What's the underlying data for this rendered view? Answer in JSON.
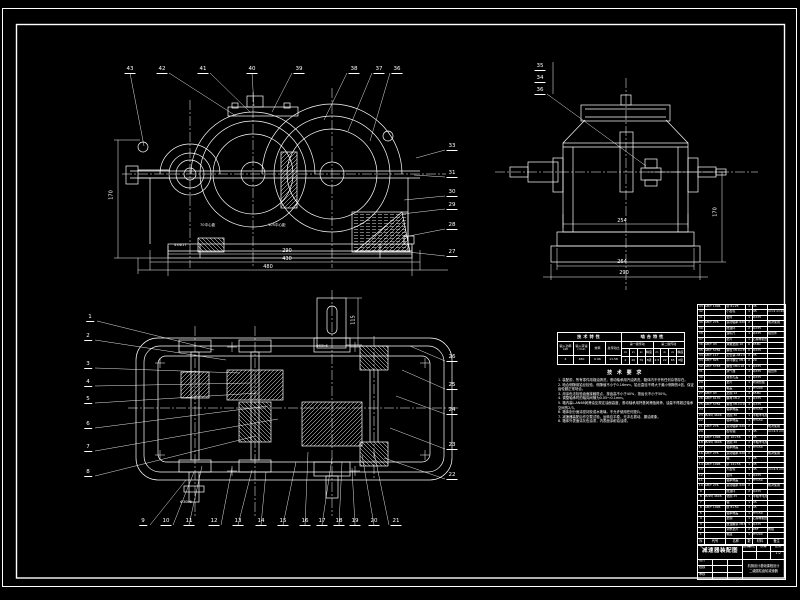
{
  "sheet": {
    "bg": "#000000",
    "line_color": "#ffffff"
  },
  "views": {
    "front": {
      "callouts": [
        {
          "n": "43",
          "x": 130,
          "y": 66,
          "tx": 144,
          "ty": 146
        },
        {
          "n": "42",
          "x": 162,
          "y": 66,
          "tx": 236,
          "ty": 116
        },
        {
          "n": "41",
          "x": 203,
          "y": 66,
          "tx": 250,
          "ty": 112
        },
        {
          "n": "40",
          "x": 252,
          "y": 66,
          "tx": 254,
          "ty": 106
        },
        {
          "n": "39",
          "x": 299,
          "y": 66,
          "tx": 272,
          "ty": 112
        },
        {
          "n": "38",
          "x": 354,
          "y": 66,
          "tx": 324,
          "ty": 120
        },
        {
          "n": "37",
          "x": 379,
          "y": 66,
          "tx": 348,
          "ty": 131
        },
        {
          "n": "36",
          "x": 397,
          "y": 66,
          "tx": 370,
          "ty": 141
        },
        {
          "n": "33",
          "x": 452,
          "y": 143,
          "tx": 416,
          "ty": 158
        },
        {
          "n": "31",
          "x": 452,
          "y": 170,
          "tx": 414,
          "ty": 175
        },
        {
          "n": "30",
          "x": 452,
          "y": 189,
          "tx": 404,
          "ty": 200
        },
        {
          "n": "29",
          "x": 452,
          "y": 202,
          "tx": 402,
          "ty": 214
        },
        {
          "n": "28",
          "x": 452,
          "y": 222,
          "tx": 404,
          "ty": 237
        },
        {
          "n": "27",
          "x": 452,
          "y": 249,
          "tx": 408,
          "ty": 252
        }
      ],
      "dims": [
        {
          "t": "290",
          "x": 287,
          "y": 249
        },
        {
          "t": "430",
          "x": 287,
          "y": 257
        },
        {
          "t": "480",
          "x": 268,
          "y": 265
        },
        {
          "t": "170",
          "x": 112,
          "y": 195,
          "rot": 1
        }
      ],
      "notes": [
        {
          "t": "70中心距",
          "x": 200,
          "y": 223
        },
        {
          "t": "105中心距",
          "x": 268,
          "y": 223
        },
        {
          "t": "4×Φ17",
          "x": 174,
          "y": 243
        }
      ]
    },
    "side": {
      "callouts": [
        {
          "n": "35",
          "x": 540,
          "y": 63
        },
        {
          "n": "34",
          "x": 540,
          "y": 75
        },
        {
          "n": "36",
          "x": 540,
          "y": 87,
          "tx": 646,
          "ty": 166
        }
      ],
      "dims": [
        {
          "t": "254",
          "x": 622,
          "y": 219
        },
        {
          "t": "264",
          "x": 622,
          "y": 260
        },
        {
          "t": "290",
          "x": 624,
          "y": 271
        },
        {
          "t": "170",
          "x": 716,
          "y": 212,
          "rot": 1
        }
      ]
    },
    "plan": {
      "callouts": [
        {
          "n": "1",
          "x": 90,
          "y": 314,
          "tx": 214,
          "ty": 350
        },
        {
          "n": "2",
          "x": 88,
          "y": 333,
          "tx": 226,
          "ty": 360
        },
        {
          "n": "3",
          "x": 88,
          "y": 361,
          "tx": 240,
          "ty": 373
        },
        {
          "n": "4",
          "x": 88,
          "y": 379,
          "tx": 250,
          "ty": 383
        },
        {
          "n": "5",
          "x": 88,
          "y": 396,
          "tx": 258,
          "ty": 393
        },
        {
          "n": "6",
          "x": 88,
          "y": 421,
          "tx": 268,
          "ty": 406
        },
        {
          "n": "7",
          "x": 88,
          "y": 444,
          "tx": 278,
          "ty": 419
        },
        {
          "n": "8",
          "x": 88,
          "y": 469,
          "tx": 256,
          "ty": 436
        },
        {
          "n": "9",
          "x": 143,
          "y": 518,
          "tx": 186,
          "ty": 480
        },
        {
          "n": "10",
          "x": 166,
          "y": 518,
          "tx": 194,
          "ty": 472
        },
        {
          "n": "11",
          "x": 189,
          "y": 518,
          "tx": 202,
          "ty": 466
        },
        {
          "n": "12",
          "x": 214,
          "y": 518,
          "tx": 232,
          "ty": 468
        },
        {
          "n": "13",
          "x": 238,
          "y": 518,
          "tx": 252,
          "ty": 470
        },
        {
          "n": "14",
          "x": 261,
          "y": 518,
          "tx": 266,
          "ty": 472
        },
        {
          "n": "15",
          "x": 283,
          "y": 518,
          "tx": 296,
          "ty": 462
        },
        {
          "n": "16",
          "x": 305,
          "y": 518,
          "tx": 308,
          "ty": 452
        },
        {
          "n": "17",
          "x": 322,
          "y": 518,
          "tx": 332,
          "ty": 458
        },
        {
          "n": "18",
          "x": 339,
          "y": 518,
          "tx": 342,
          "ty": 462
        },
        {
          "n": "19",
          "x": 355,
          "y": 518,
          "tx": 352,
          "ty": 468
        },
        {
          "n": "20",
          "x": 374,
          "y": 518,
          "tx": 362,
          "ty": 455
        },
        {
          "n": "21",
          "x": 396,
          "y": 518,
          "tx": 374,
          "ty": 452
        },
        {
          "n": "26",
          "x": 452,
          "y": 354,
          "tx": 410,
          "ty": 346
        },
        {
          "n": "25",
          "x": 452,
          "y": 382,
          "tx": 402,
          "ty": 370
        },
        {
          "n": "24",
          "x": 452,
          "y": 407,
          "tx": 396,
          "ty": 396
        },
        {
          "n": "23",
          "x": 452,
          "y": 442,
          "tx": 390,
          "ty": 428
        },
        {
          "n": "22",
          "x": 452,
          "y": 472,
          "tx": 384,
          "ty": 458
        }
      ],
      "dims": [
        {
          "t": "115",
          "x": 354,
          "y": 320,
          "rot": 1
        }
      ],
      "notes": [
        {
          "t": "Φ55k6",
          "x": 316,
          "y": 344
        },
        {
          "t": "Φ30k6",
          "x": 180,
          "y": 500
        }
      ]
    }
  },
  "spec_table": {
    "left_header": "技术特性",
    "right_header": "啮合特性",
    "left_cols": [
      "输入功率 kW",
      "输入转速 r/min",
      "效率",
      "总传动比"
    ],
    "left_vals": [
      "4",
      "480",
      "0.96",
      "11.58"
    ],
    "stage1": "第一级传动",
    "stage2": "第二级传动",
    "gear_cols1": [
      "m",
      "z₁",
      "z₂",
      "精度"
    ],
    "gear_vals1": [
      "2",
      "20",
      "79",
      "8级"
    ],
    "gear_cols2": [
      "m",
      "z₁",
      "z₂",
      "精度"
    ],
    "gear_vals2": [
      "2.5",
      "22",
      "65",
      "8级"
    ]
  },
  "tech_req": {
    "title": "技 术 要 求",
    "lines": [
      "1. 装配前，所有零件用煤油清洗，滚动轴承用汽油清洗，箱体内不许有任何杂物存在。",
      "2. 啮合侧隙用铅丝检验，侧隙值不小于0.16mm，铅丝直径不得大于最小侧隙的4倍，保证齿轮副正常啮合。",
      "3. 用涂色法检验齿面接触斑点，按齿高不小于40%，按齿长不小于50%。",
      "4. 调整轴承时的轴向间隙为0.05～0.1mm。",
      "5. 箱内装L-AN68润滑油至规定油面高度，滚动轴承用钙基润滑脂润滑，油量不得超过轴承空间的2/3。",
      "6. 箱体剖分面涂密封胶或水玻璃，不允许使用任何垫片。",
      "7. 减速器装配后作空载试验，运转应平稳，无冲击振动、漏油现象。",
      "8. 箱体外表面涂灰色油漆，内表面涂耐油油漆。"
    ]
  },
  "bom": {
    "headers": [
      "序号",
      "代号",
      "名称",
      "数量",
      "材料",
      "备注"
    ],
    "rows": [
      [
        "43",
        "GB/T 1096",
        "键 6×25",
        "1",
        "45",
        ""
      ],
      [
        "42",
        "",
        "小齿轮",
        "1",
        "45",
        "m=2 z=20"
      ],
      [
        "41",
        "",
        "套筒",
        "1",
        "Q235",
        ""
      ],
      [
        "40",
        "GB/T 276",
        "滚动轴承 6205",
        "2",
        "",
        "成对使用"
      ],
      [
        "39",
        "",
        "挡油环",
        "2",
        "Q235",
        ""
      ],
      [
        "38",
        "",
        "油标尺",
        "1",
        "Q235",
        "组合件"
      ],
      [
        "37",
        "",
        "垫片",
        "1",
        "石棉橡胶纸",
        ""
      ],
      [
        "36",
        "GB/T 93",
        "弹簧垫圈 10",
        "6",
        "65Mn",
        ""
      ],
      [
        "35",
        "GB/T 5782",
        "螺栓 M10×35",
        "6",
        "Q235",
        ""
      ],
      [
        "34",
        "GB/T 117",
        "定位销 A8×30",
        "2",
        "35",
        ""
      ],
      [
        "33",
        "GB/T 825",
        "吊环螺钉 M10",
        "2",
        "20",
        ""
      ],
      [
        "32",
        "GB/T 5783",
        "螺栓 M6×16",
        "4",
        "Q235",
        ""
      ],
      [
        "31",
        "",
        "通气器",
        "1",
        "Q235",
        "组合件"
      ],
      [
        "30",
        "",
        "窥视孔盖",
        "1",
        "Q235",
        ""
      ],
      [
        "29",
        "",
        "垫片",
        "1",
        "软钢纸板",
        ""
      ],
      [
        "28",
        "",
        "箱盖",
        "1",
        "HT200",
        ""
      ],
      [
        "27",
        "GB/T 93",
        "垫圈 12",
        "4",
        "65Mn",
        ""
      ],
      [
        "26",
        "GB/T 6170",
        "螺母 M12",
        "4",
        "Q235",
        ""
      ],
      [
        "25",
        "GB/T 5782",
        "螺栓 M12×100",
        "4",
        "Q235",
        ""
      ],
      [
        "24",
        "",
        "轴承端盖",
        "1",
        "HT150",
        ""
      ],
      [
        "23",
        "JB/ZQ 4606",
        "毡圈 30",
        "1",
        "半粗羊毛毡",
        ""
      ],
      [
        "22",
        "",
        "轴承端盖",
        "1",
        "HT150",
        ""
      ],
      [
        "21",
        "GB/T 276",
        "滚动轴承 6207",
        "2",
        "",
        "成对使用"
      ],
      [
        "20",
        "",
        "齿轮轴",
        "1",
        "45",
        "m=2.5 z=22"
      ],
      [
        "19",
        "GB/T 1096",
        "键 10×56",
        "1",
        "45",
        ""
      ],
      [
        "18",
        "JB/ZQ 4606",
        "毡圈 40",
        "1",
        "半粗羊毛毡",
        ""
      ],
      [
        "17",
        "",
        "轴承端盖",
        "1",
        "HT150",
        ""
      ],
      [
        "16",
        "GB/T 276",
        "滚动轴承 6208",
        "2",
        "",
        "成对使用"
      ],
      [
        "15",
        "",
        "轴",
        "1",
        "45",
        ""
      ],
      [
        "14",
        "GB/T 1096",
        "键 14×56",
        "1",
        "45",
        ""
      ],
      [
        "13",
        "",
        "大齿轮",
        "1",
        "45",
        "m=2.5 z=65"
      ],
      [
        "12",
        "",
        "套筒",
        "1",
        "Q235",
        ""
      ],
      [
        "11",
        "",
        "轴承端盖",
        "1",
        "HT150",
        ""
      ],
      [
        "10",
        "GB/T 276",
        "滚动轴承 6206",
        "2",
        "",
        "成对使用"
      ],
      [
        "9",
        "",
        "挡油环",
        "2",
        "Q235",
        ""
      ],
      [
        "8",
        "JB/ZQ 4606",
        "毡圈 25",
        "1",
        "半粗羊毛毡",
        ""
      ],
      [
        "7",
        "",
        "轴",
        "1",
        "45",
        ""
      ],
      [
        "6",
        "GB/T 1096",
        "键 8×50",
        "1",
        "45",
        ""
      ],
      [
        "5",
        "",
        "轴承端盖",
        "1",
        "HT150",
        ""
      ],
      [
        "4",
        "",
        "垫圈",
        "1",
        "石棉橡胶纸",
        ""
      ],
      [
        "3",
        "",
        "放油螺塞 M16×1.5",
        "1",
        "Q235",
        ""
      ],
      [
        "2",
        "",
        "调整垫片",
        "2",
        "08F",
        "成组"
      ],
      [
        "1",
        "",
        "箱座",
        "1",
        "HT200",
        ""
      ]
    ]
  },
  "title_block": {
    "drawing_name": "减速器装配图",
    "grid_row1": [
      "图样标记",
      "质量",
      "比例"
    ],
    "grid_row2": [
      "",
      "",
      "1:2"
    ],
    "sign_rows": [
      [
        "设计",
        "",
        ""
      ],
      [
        "校核",
        "",
        ""
      ],
      [
        "审核",
        "",
        ""
      ]
    ],
    "course_line1": "机械设计基础课程设计",
    "course_line2": "二级圆柱齿轮减速器"
  }
}
